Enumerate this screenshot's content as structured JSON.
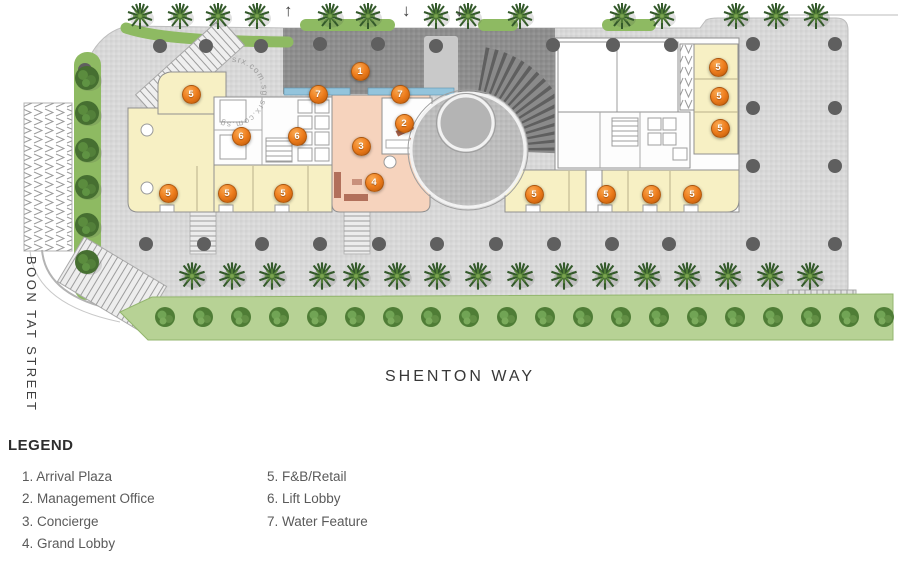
{
  "plan": {
    "street_left": "BOON TAT STREET",
    "street_bottom": "SHENTON WAY",
    "watermark": "srx.com.sg  srx.com.sg",
    "arrows": [
      {
        "glyph": "↑",
        "x": 291
      },
      {
        "glyph": "↓",
        "x": 409
      },
      {
        "glyph": "↓",
        "x": 462
      }
    ],
    "markers": [
      {
        "n": "1",
        "x": 359,
        "y": 70
      },
      {
        "n": "7",
        "x": 317,
        "y": 93
      },
      {
        "n": "7",
        "x": 399,
        "y": 93
      },
      {
        "n": "2",
        "x": 403,
        "y": 122
      },
      {
        "n": "6",
        "x": 240,
        "y": 135
      },
      {
        "n": "6",
        "x": 296,
        "y": 135
      },
      {
        "n": "3",
        "x": 360,
        "y": 145
      },
      {
        "n": "4",
        "x": 373,
        "y": 181
      },
      {
        "n": "5",
        "x": 190,
        "y": 93
      },
      {
        "n": "5",
        "x": 167,
        "y": 192
      },
      {
        "n": "5",
        "x": 226,
        "y": 192
      },
      {
        "n": "5",
        "x": 282,
        "y": 192
      },
      {
        "n": "5",
        "x": 717,
        "y": 66
      },
      {
        "n": "5",
        "x": 718,
        "y": 95
      },
      {
        "n": "5",
        "x": 719,
        "y": 127
      },
      {
        "n": "5",
        "x": 533,
        "y": 193
      },
      {
        "n": "5",
        "x": 605,
        "y": 193
      },
      {
        "n": "5",
        "x": 650,
        "y": 193
      },
      {
        "n": "5",
        "x": 691,
        "y": 193
      }
    ]
  },
  "legend": {
    "title": "LEGEND",
    "col1": [
      "1. Arrival Plaza",
      "2. Management Office",
      "3. Concierge",
      "4. Grand Lobby"
    ],
    "col2": [
      "5. F&B/Retail",
      "6. Lift Lobby",
      "7. Water Feature"
    ]
  },
  "colors": {
    "marker_orange": "#ee7d1d",
    "fnb_yellow": "#f7f0c4",
    "lobby_salmon": "#f6d3bd",
    "water_blue": "#93c4dc",
    "plaza_gray": "#d8d8d8",
    "arrival_dark": "#8e8e8e",
    "green": "#8eba62"
  }
}
